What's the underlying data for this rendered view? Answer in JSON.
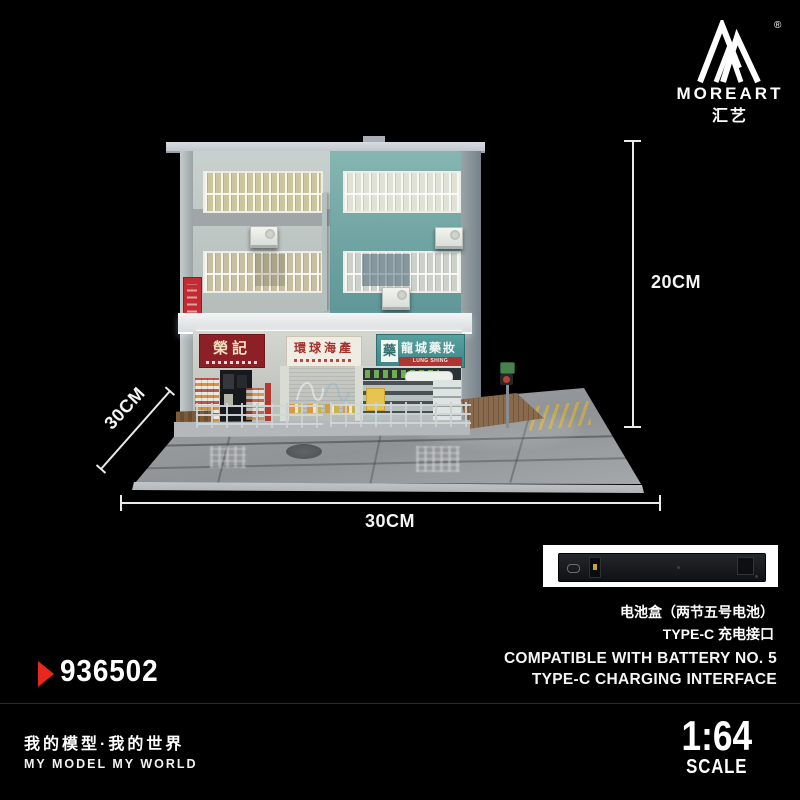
{
  "background": "#000000",
  "brand": {
    "logo_text": "MOREART",
    "logo_cn": "汇艺",
    "registered_mark": "®"
  },
  "dimensions": {
    "height_label": "20CM",
    "depth_label": "30CM",
    "width_label": "30CM"
  },
  "model": {
    "shops": [
      {
        "sign_main": "榮記"
      },
      {
        "sign_main": "環球海產"
      },
      {
        "badge": "藥",
        "sign_main": "龍城藥妝",
        "sign_sub_en": "LUNG SHING MEDICINE"
      }
    ]
  },
  "battery": {
    "cn_line1": "电池盒（两节五号电池）",
    "cn_line2": "TYPE-C 充电接口",
    "en_line1": "COMPATIBLE WITH BATTERY NO. 5",
    "en_line2": "TYPE-C CHARGING INTERFACE"
  },
  "product_code": "936502",
  "scale": {
    "ratio": "1:64",
    "label": "SCALE"
  },
  "footer": {
    "slogan_cn": "我的模型·我的世界",
    "slogan_en": "MY MODEL MY WORLD"
  },
  "colors": {
    "accent_red": "#e8281e",
    "facade_teal": "#67a0a0",
    "facade_gray": "#c0c9c6",
    "pharmacy_sign_teal": "#3f8789",
    "shop_sign_red": "#8c2026",
    "street_gray": "#95999c"
  }
}
